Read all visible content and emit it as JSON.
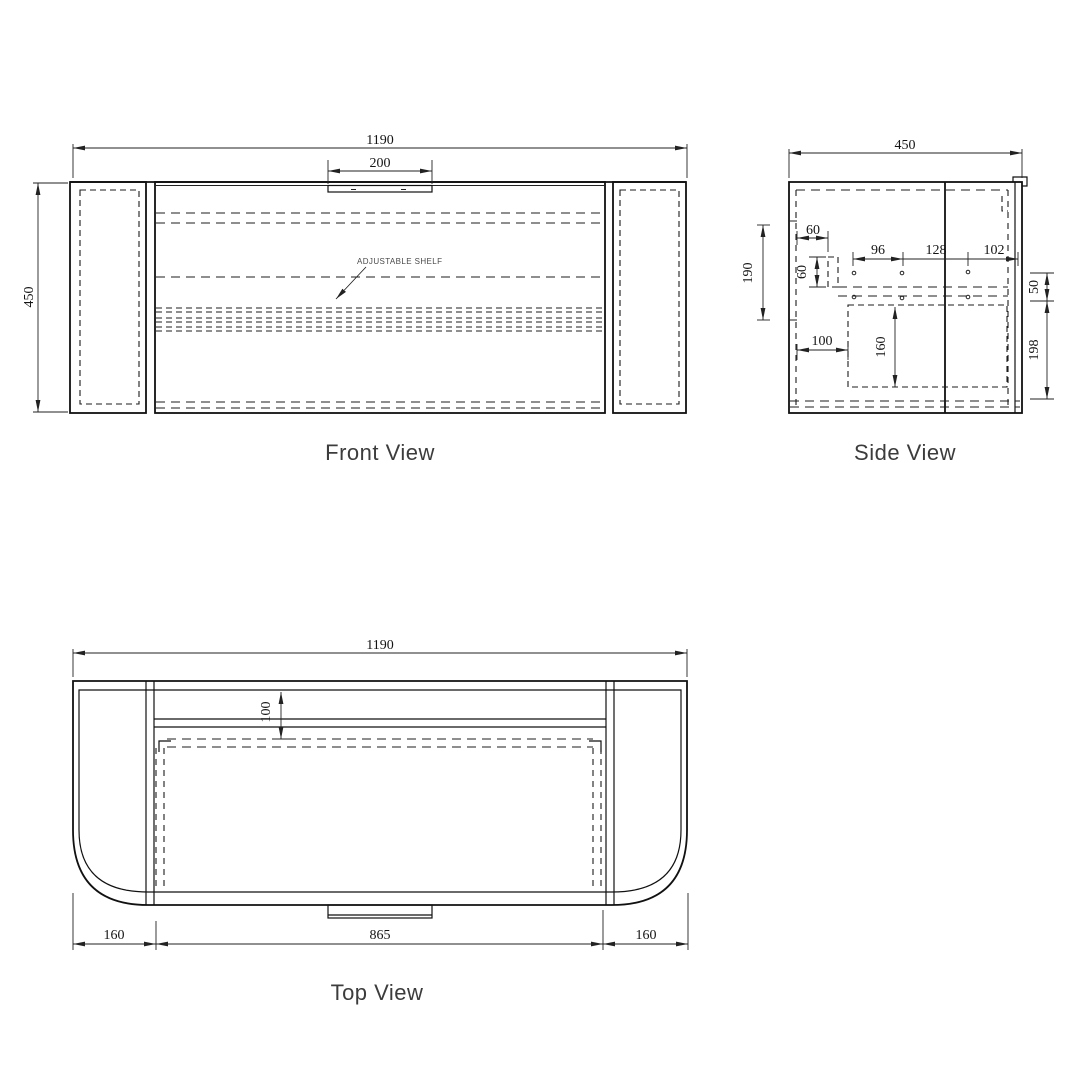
{
  "front_view": {
    "title": "Front View",
    "shelf_label": "ADJUSTABLE SHELF",
    "dim_overall_width": "1190",
    "dim_rail_cutout": "200",
    "dim_height": "450"
  },
  "side_view": {
    "title": "Side View",
    "dim_depth": "450",
    "dim_left_height": "190",
    "dim_top_offset": "60",
    "dim_bracket_height": "60",
    "dim_hole_pitch_1": "96",
    "dim_hole_pitch_2": "128",
    "dim_hole_pitch_3": "102",
    "dim_bottom_offset": "100",
    "dim_drawer_height": "160",
    "dim_right_top": "50",
    "dim_right_bottom": "198"
  },
  "top_view": {
    "title": "Top View",
    "dim_overall_width": "1190",
    "dim_back_rail": "100",
    "dim_opening_width": "865",
    "dim_corner_left": "160",
    "dim_corner_right": "160"
  },
  "colors": {
    "line": "#111111",
    "dimension_text": "#141414",
    "title_text": "#3c3c3c",
    "background": "#ffffff"
  }
}
